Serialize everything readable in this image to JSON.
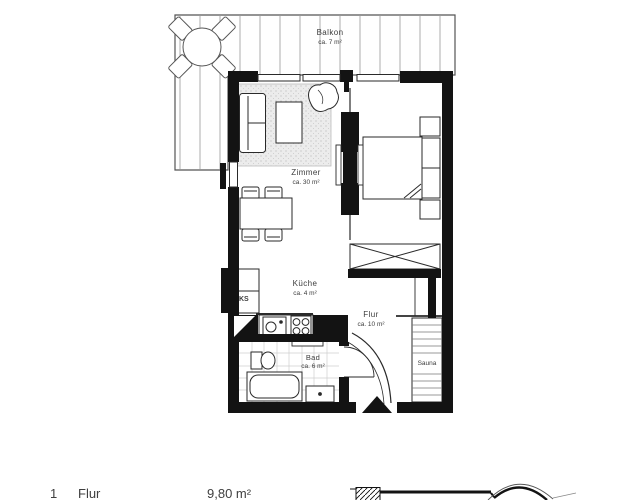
{
  "plan": {
    "title": "Apartment floor plan",
    "rooms": {
      "balkon": {
        "name": "Balkon",
        "area": "ca. 7 m²"
      },
      "zimmer": {
        "name": "Zimmer",
        "area": "ca. 30 m²"
      },
      "kueche": {
        "name": "Küche",
        "area": "ca. 4 m²"
      },
      "flur": {
        "name": "Flur",
        "area": "ca. 10 m²"
      },
      "bad": {
        "name": "Bad",
        "area": "ca. 6 m²"
      },
      "sauna": {
        "name": "Sauna"
      },
      "ks": {
        "label": "KS"
      }
    },
    "legend": {
      "index": "1",
      "room": "Flur",
      "area": "9,80 m²"
    },
    "colors": {
      "wall": "#131313",
      "line": "#2a2a2a",
      "rug": "#ececec",
      "text": "#3d3d3d"
    }
  }
}
